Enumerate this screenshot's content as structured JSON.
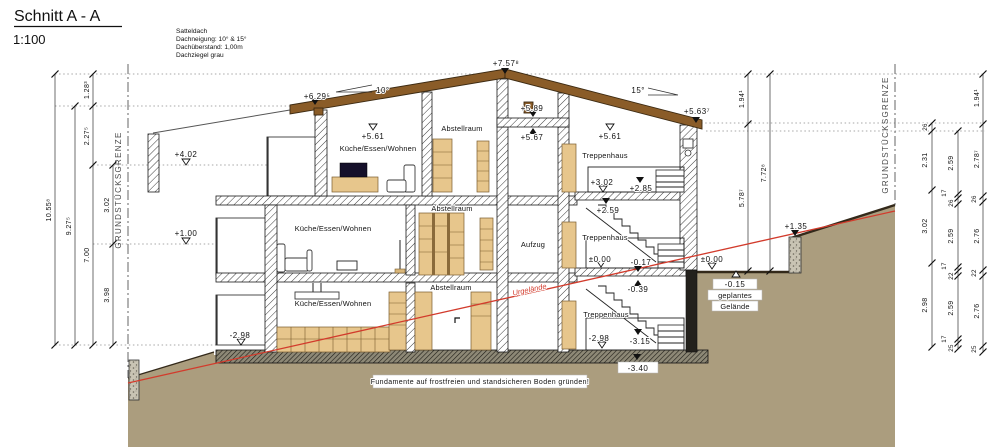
{
  "labels": {
    "title": "Schnitt A - A",
    "scale": "1:100",
    "spec1": "Satteldach",
    "spec2": "Dachneigung: 10° & 15°",
    "spec3": "Dachüberstand: 1,00m",
    "spec4": "Dachziegel grau",
    "grenze": "GRUNDSTÜCKSGRENZE",
    "note": "Fundamente auf frostfreien und standsicheren Boden gründen!",
    "urgelaende": "Urgelände",
    "slope_left": "10°",
    "slope_right": "15°",
    "geplant1": "geplantes",
    "geplant2": "Gelände"
  },
  "rooms": {
    "kueche": "Küche/Essen/Wohnen",
    "abstell": "Abstellraum",
    "treppe": "Treppenhaus",
    "aufzug": "Aufzug"
  },
  "levels": {
    "ridge": "+7.57⁸",
    "eave_left": "+6.29⁵",
    "lift_top": "+5.89",
    "lift_bottom": "+5.67",
    "og2_left": "+5.61",
    "og2_right": "+5.61",
    "eave_right": "+5.63⁷",
    "p402": "+4.02",
    "p302": "+3.02",
    "p285": "+2.85",
    "p259": "+2.59",
    "p135": "+1.35",
    "p100": "+1.00",
    "zero_stair": "±0.00",
    "zero_out": "±0.00",
    "m015": "-0.15",
    "m017": "-0.17",
    "m039": "-0.39",
    "m298_terrace": "-2.98",
    "m298_stair": "-2.98",
    "m315": "-3.15",
    "m340": "-3.40"
  },
  "dims": {
    "h1055": "10.55⁸",
    "h927": "9.27⁵",
    "h128": "1.28³",
    "h227": "2.27⁵",
    "h700": "7.00",
    "h302": "3.02",
    "h398": "3.98",
    "r194": "1.94¹",
    "r578": "5.78⁷",
    "r772": "7.72⁸",
    "a26": "26",
    "a231": "2.31",
    "a302": "3.02",
    "a298": "2.98",
    "b259a": "2.59",
    "b17a": "17",
    "b26": "26",
    "b259b": "2.59",
    "b17b": "17",
    "b22": "22",
    "b259c": "2.59",
    "b17c": "17",
    "b25": "25",
    "c194": "1.94¹",
    "c278": "2.78⁷",
    "c26": "26",
    "c276a": "2.76",
    "c22": "22",
    "c276b": "2.76",
    "c25": "25"
  },
  "colors": {
    "ground": "#ab9d7e",
    "roof": "#8a5c28",
    "terrain_existing_line": "#d23b2c",
    "wood": "#e7c68c"
  }
}
